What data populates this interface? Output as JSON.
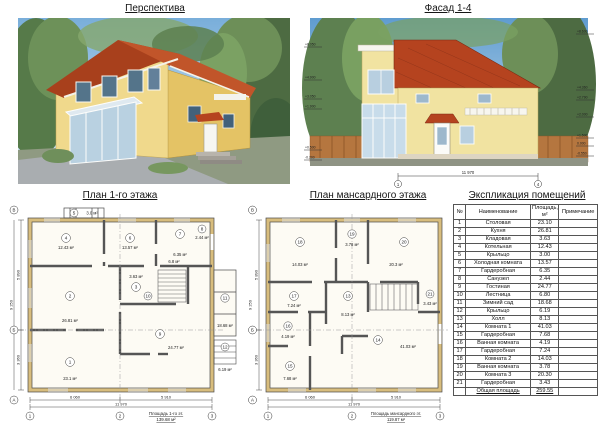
{
  "perspective": {
    "title": "Перспектива"
  },
  "facade": {
    "title": "Фасад 1-4",
    "elev_left": [
      "+8.050",
      "+4.900",
      "+3.050",
      "+1.900",
      "+0.500",
      "-0.200"
    ],
    "elev_right": [
      "+8.600",
      "+4.360",
      "+2.790",
      "+2.000",
      "+1.500",
      "0.000",
      "-0.550"
    ],
    "dim_total": "11 970",
    "axis_left": "1",
    "axis_right": "4"
  },
  "plan1": {
    "title": "План 1-го этажа",
    "caption": "Площадь 1-го эт.",
    "caption_value": "139.68 м²",
    "grid": {
      "row_top": "В",
      "row_mid": "Б",
      "row_bottom": "А",
      "col1": "1",
      "col2": "2",
      "col3": "3"
    },
    "dims": {
      "b1": "6 060",
      "b2": "5 910",
      "bt": "11 970",
      "l1": "5 890",
      "l2": "3 360",
      "lt": "9 250"
    },
    "rooms": [
      {
        "num": "5",
        "area": "3.0 м²"
      },
      {
        "num": "4",
        "area": "12.43 м²"
      },
      {
        "num": "6",
        "area": "13.57 м²"
      },
      {
        "num": "7",
        "area": "6.35 м²"
      },
      {
        "num": "8",
        "area": "2.44 м²"
      },
      {
        "num": "2",
        "area": "26.81 м²"
      },
      {
        "num": "3",
        "area": "3.63 м²"
      },
      {
        "num": "10",
        "area": "6.8 м²"
      },
      {
        "num": "1",
        "area": "23.1 м²"
      },
      {
        "num": "9",
        "area": "24.77 м²"
      },
      {
        "num": "11",
        "area": "18.68 м²"
      },
      {
        "num": "12",
        "area": "6.19 м²"
      }
    ]
  },
  "plan2": {
    "title": "План мансардного этажа",
    "caption": "Площадь мансардного эт.",
    "caption_value": "119.87 м²",
    "grid": {
      "row_top": "В",
      "row_mid": "Б",
      "row_bottom": "А",
      "col1": "1",
      "col2": "2",
      "col3": "3"
    },
    "dims": {
      "b1": "6 060",
      "b2": "5 910",
      "bt": "11 970",
      "l1": "5 890",
      "l2": "3 360",
      "lt": "9 250"
    },
    "rooms": [
      {
        "num": "18",
        "area": "14.03 м²"
      },
      {
        "num": "19",
        "area": "3.78 м²"
      },
      {
        "num": "20",
        "area": "20.3 м²"
      },
      {
        "num": "13",
        "area": "8.13 м²"
      },
      {
        "num": "21",
        "area": "3.43 м²"
      },
      {
        "num": "17",
        "area": "7.24 м²"
      },
      {
        "num": "16",
        "area": "4.19 м²"
      },
      {
        "num": "15",
        "area": "7.68 м²"
      },
      {
        "num": "14",
        "area": "41.03 м²"
      }
    ]
  },
  "table": {
    "title": "Экспликация помещений",
    "headers": {
      "no": "№",
      "name": "Наименование",
      "area": "Площадь, м²",
      "note": "Примечание"
    },
    "rows": [
      {
        "no": "1",
        "name": "Столовая",
        "area": "23.10",
        "note": ""
      },
      {
        "no": "2",
        "name": "Кухня",
        "area": "26.81",
        "note": ""
      },
      {
        "no": "3",
        "name": "Кладовая",
        "area": "3.63",
        "note": ""
      },
      {
        "no": "4",
        "name": "Котельная",
        "area": "12.43",
        "note": ""
      },
      {
        "no": "5",
        "name": "Крыльцо",
        "area": "3.00",
        "note": ""
      },
      {
        "no": "6",
        "name": "Холодная комната",
        "area": "13.57",
        "note": ""
      },
      {
        "no": "7",
        "name": "Гардеробная",
        "area": "6.35",
        "note": ""
      },
      {
        "no": "8",
        "name": "Санузел",
        "area": "2.44",
        "note": ""
      },
      {
        "no": "9",
        "name": "Гостиная",
        "area": "24.77",
        "note": ""
      },
      {
        "no": "10",
        "name": "Лестница",
        "area": "6.80",
        "note": ""
      },
      {
        "no": "11",
        "name": "Зимний сад",
        "area": "18.68",
        "note": ""
      },
      {
        "no": "12",
        "name": "Крыльцо",
        "area": "6.19",
        "note": ""
      },
      {
        "no": "13",
        "name": "Холл",
        "area": "8.13",
        "note": ""
      },
      {
        "no": "14",
        "name": "Комната 1",
        "area": "41.03",
        "note": ""
      },
      {
        "no": "15",
        "name": "Гардеробная",
        "area": "7.68",
        "note": ""
      },
      {
        "no": "16",
        "name": "Ванная комната",
        "area": "4.19",
        "note": ""
      },
      {
        "no": "17",
        "name": "Гардеробная",
        "area": "7.24",
        "note": ""
      },
      {
        "no": "18",
        "name": "Комната 2",
        "area": "14.03",
        "note": ""
      },
      {
        "no": "19",
        "name": "Ванная комната",
        "area": "3.78",
        "note": ""
      },
      {
        "no": "20",
        "name": "Комната 3",
        "area": "20.30",
        "note": ""
      },
      {
        "no": "21",
        "name": "Гардеробная",
        "area": "3.43",
        "note": ""
      }
    ],
    "total_label": "Общая площадь",
    "total_value": "259.55"
  },
  "colors": {
    "roof": "#b5431f",
    "wall": "#f1e3a1",
    "glass": "#c8dcea",
    "sky": "#6fa7d6",
    "tree": "#5d8050",
    "plan_wall": "#d8bd7d"
  }
}
